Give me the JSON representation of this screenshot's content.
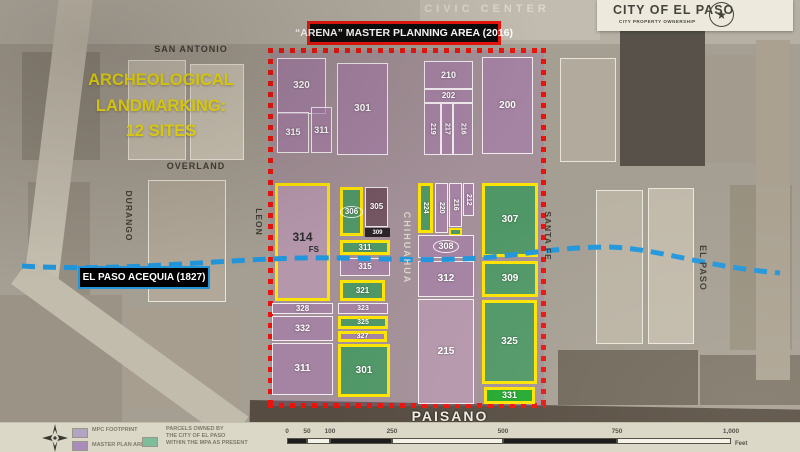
{
  "title_boxes": {
    "arena": "“ARENA” MASTER PLANNING AREA (2016)",
    "city_title": "CITY OF EL PASO",
    "city_subtitle": "CITY PROPERTY OWNERSHIP"
  },
  "annotations": {
    "arch_line1": "ARCHEOLOGICAL",
    "arch_line2": "LANDMARKING:",
    "arch_line3": "12 SITES",
    "acequia": "EL PASO ACEQUIA (1827)"
  },
  "streets": [
    {
      "label": "CIVIC CENTER",
      "x": 487,
      "y": 9,
      "cls": "light",
      "fs": 11,
      "ls": 4
    },
    {
      "label": "SAN ANTONIO",
      "x": 191,
      "y": 49,
      "cls": "dark",
      "fs": 9,
      "ls": 1
    },
    {
      "label": "OVERLAND",
      "x": 196,
      "y": 166,
      "cls": "dark",
      "fs": 9,
      "ls": 1
    },
    {
      "label": "DURANGO",
      "x": 129,
      "y": 216,
      "cls": "dark",
      "fs": 8.5,
      "ls": 1,
      "v": 1
    },
    {
      "label": "LEON",
      "x": 259,
      "y": 222,
      "cls": "dark",
      "fs": 8.5,
      "ls": 1,
      "v": 1
    },
    {
      "label": "CHIHUAHUA",
      "x": 407,
      "y": 248,
      "cls": "light",
      "fs": 9,
      "ls": 2,
      "v": 1
    },
    {
      "label": "SANTA FE",
      "x": 548,
      "y": 236,
      "cls": "dark",
      "fs": 8.5,
      "ls": 1,
      "v": 1
    },
    {
      "label": "EL PASO",
      "x": 703,
      "y": 268,
      "cls": "dark",
      "fs": 9,
      "ls": 1,
      "v": 1
    },
    {
      "label": "PAISANO",
      "x": 450,
      "y": 416,
      "cls": "paisano",
      "fs": 14,
      "ls": 2
    }
  ],
  "parcels": [
    {
      "label": "320",
      "x": 277,
      "y": 58,
      "w": 49,
      "h": 56,
      "f": "p"
    },
    {
      "label": "315",
      "x": 277,
      "y": 112,
      "w": 32,
      "h": 41,
      "f": "p",
      "fs": 9
    },
    {
      "label": "311",
      "x": 311,
      "y": 107,
      "w": 21,
      "h": 46,
      "f": "p",
      "fs": 9
    },
    {
      "label": "301",
      "x": 337,
      "y": 63,
      "w": 51,
      "h": 92,
      "f": "p"
    },
    {
      "label": "210",
      "x": 424,
      "y": 61,
      "w": 49,
      "h": 28,
      "f": "p",
      "fs": 9
    },
    {
      "label": "202",
      "x": 424,
      "y": 89,
      "w": 49,
      "h": 14,
      "f": "p",
      "fs": 8
    },
    {
      "label": "219",
      "x": 424,
      "y": 103,
      "w": 17,
      "h": 52,
      "f": "p",
      "v": 1,
      "fs": 7
    },
    {
      "label": "217",
      "x": 441,
      "y": 103,
      "w": 12,
      "h": 52,
      "f": "p",
      "v": 1,
      "fs": 7
    },
    {
      "label": "216",
      "x": 453,
      "y": 103,
      "w": 20,
      "h": 52,
      "f": "p",
      "v": 1,
      "fs": 7
    },
    {
      "label": "200",
      "x": 482,
      "y": 57,
      "w": 51,
      "h": 97,
      "f": "p"
    },
    {
      "label": "314",
      "x": 275,
      "y": 183,
      "w": 55,
      "h": 118,
      "f": "pl",
      "yellow": 1,
      "dark": 1,
      "sub": "FS",
      "fs": 12
    },
    {
      "label": "306",
      "x": 340,
      "y": 187,
      "w": 23,
      "h": 49,
      "f": "g",
      "yellow": 1,
      "ellipse": 1,
      "fs": 8
    },
    {
      "label": "305",
      "x": 365,
      "y": 187,
      "w": 23,
      "h": 40,
      "f": "d",
      "fs": 8
    },
    {
      "label": "309",
      "x": 365,
      "y": 228,
      "w": 25,
      "h": 9,
      "f": "k",
      "fs": 6
    },
    {
      "label": "311",
      "x": 340,
      "y": 240,
      "w": 50,
      "h": 15,
      "f": "g",
      "yellow": 1,
      "fs": 8
    },
    {
      "label": "315",
      "x": 340,
      "y": 258,
      "w": 50,
      "h": 18,
      "f": "p",
      "fs": 8
    },
    {
      "label": "321",
      "x": 340,
      "y": 280,
      "w": 45,
      "h": 21,
      "f": "g",
      "yellow": 1,
      "fs": 8
    },
    {
      "label": "323",
      "x": 338,
      "y": 303,
      "w": 50,
      "h": 11,
      "f": "p",
      "fs": 7
    },
    {
      "label": "325",
      "x": 338,
      "y": 316,
      "w": 50,
      "h": 13,
      "f": "g",
      "yellow": 1,
      "fs": 7
    },
    {
      "label": "327",
      "x": 338,
      "y": 331,
      "w": 49,
      "h": 11,
      "f": "p",
      "yellow": 1,
      "fs": 7
    },
    {
      "label": "301",
      "x": 338,
      "y": 344,
      "w": 52,
      "h": 53,
      "f": "g",
      "yellow": 1
    },
    {
      "label": "328",
      "x": 272,
      "y": 303,
      "w": 61,
      "h": 11,
      "f": "p",
      "fs": 8
    },
    {
      "label": "332",
      "x": 272,
      "y": 316,
      "w": 61,
      "h": 25,
      "f": "p",
      "fs": 9
    },
    {
      "label": "311",
      "x": 272,
      "y": 343,
      "w": 61,
      "h": 52,
      "f": "p"
    },
    {
      "label": "224",
      "x": 418,
      "y": 183,
      "w": 15,
      "h": 50,
      "f": "g",
      "yellow": 1,
      "v": 1,
      "fs": 7
    },
    {
      "label": "220",
      "x": 435,
      "y": 183,
      "w": 13,
      "h": 50,
      "f": "p",
      "v": 1,
      "fs": 7
    },
    {
      "label": "216",
      "x": 449,
      "y": 183,
      "w": 13,
      "h": 44,
      "f": "p",
      "v": 1,
      "fs": 7
    },
    {
      "label": "212",
      "x": 463,
      "y": 183,
      "w": 11,
      "h": 33,
      "f": "p",
      "v": 1,
      "fs": 7
    },
    {
      "label": "",
      "x": 449,
      "y": 228,
      "w": 13,
      "h": 8,
      "f": "g2"
    },
    {
      "label": "308",
      "x": 418,
      "y": 235,
      "w": 56,
      "h": 23,
      "f": "p",
      "ellipse": 1,
      "fs": 9
    },
    {
      "label": "312",
      "x": 418,
      "y": 261,
      "w": 56,
      "h": 36,
      "f": "p"
    },
    {
      "label": "215",
      "x": 418,
      "y": 299,
      "w": 56,
      "h": 105,
      "f": "pl"
    },
    {
      "label": "307",
      "x": 482,
      "y": 183,
      "w": 56,
      "h": 74,
      "f": "g",
      "yellow": 1
    },
    {
      "label": "309",
      "x": 482,
      "y": 261,
      "w": 56,
      "h": 36,
      "f": "g",
      "yellow": 1
    },
    {
      "label": "325",
      "x": 482,
      "y": 300,
      "w": 55,
      "h": 84,
      "f": "g",
      "yellow": 1
    },
    {
      "label": "331",
      "x": 484,
      "y": 387,
      "w": 51,
      "h": 17,
      "f": "gb",
      "yellow": 1,
      "fs": 9
    }
  ],
  "legend": {
    "items": [
      {
        "color": "#b3a4c4",
        "label": "MPC FOOTPRINT"
      },
      {
        "color": "#aa8cba",
        "label": "MASTER PLAN AREA"
      },
      {
        "color": "#7dbd99",
        "label": "PARCELS OWNED BY\nTHE CITY OF EL PASO\nWITHIN THE MPA AS PRESENT"
      }
    ],
    "scale_ticks": [
      "0",
      "50",
      "100",
      "250",
      "500",
      "750",
      "1,000"
    ],
    "scale_unit": "Feet"
  },
  "colors": {
    "red_dash": "#e8140c",
    "yellow_outline": "#ffe303",
    "acequia_blue": "#2196dc",
    "green_parcel": "#499863",
    "bright_green": "#21a92e",
    "purple_overlay": "#a070a6"
  }
}
